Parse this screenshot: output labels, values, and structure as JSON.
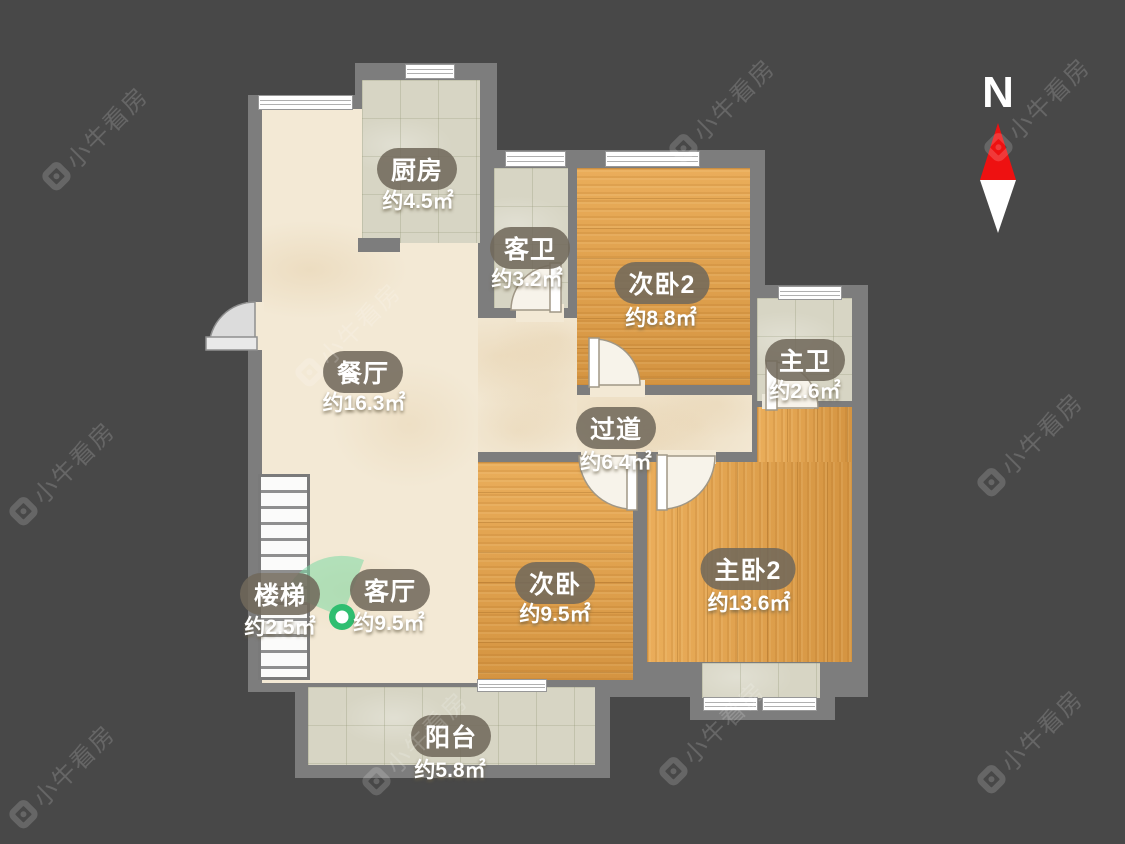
{
  "title": "户型图",
  "compass": {
    "label": "N"
  },
  "watermark": {
    "text": "小牛看房"
  },
  "rooms": [
    {
      "id": "kitchen",
      "label": "厨房",
      "area": "约4.5㎡"
    },
    {
      "id": "guest-bath",
      "label": "客卫",
      "area": "约3.2㎡"
    },
    {
      "id": "bedroom2",
      "label": "次卧2",
      "area": "约8.8㎡"
    },
    {
      "id": "master-bath",
      "label": "主卫",
      "area": "约2.6㎡"
    },
    {
      "id": "dining",
      "label": "餐厅",
      "area": "约16.3㎡"
    },
    {
      "id": "hallway",
      "label": "过道",
      "area": "约6.4㎡"
    },
    {
      "id": "bedroom",
      "label": "次卧",
      "area": "约9.5㎡"
    },
    {
      "id": "master-bedroom2",
      "label": "主卧2",
      "area": "约13.6㎡"
    },
    {
      "id": "stairs",
      "label": "楼梯",
      "area": "约2.5㎡"
    },
    {
      "id": "living",
      "label": "客厅",
      "area": "约9.5㎡"
    },
    {
      "id": "balcony",
      "label": "阳台",
      "area": "约5.8㎡"
    }
  ],
  "colors": {
    "background": "#484848",
    "wall": "#7d7d7d",
    "floor_cream": "#f3e9d5",
    "floor_tile": "#d7d5c4",
    "floor_wood": "#e2a14b",
    "label_pill": "#70695b",
    "north_red": "#ee1111",
    "viewpoint_green": "#2fbe70"
  }
}
